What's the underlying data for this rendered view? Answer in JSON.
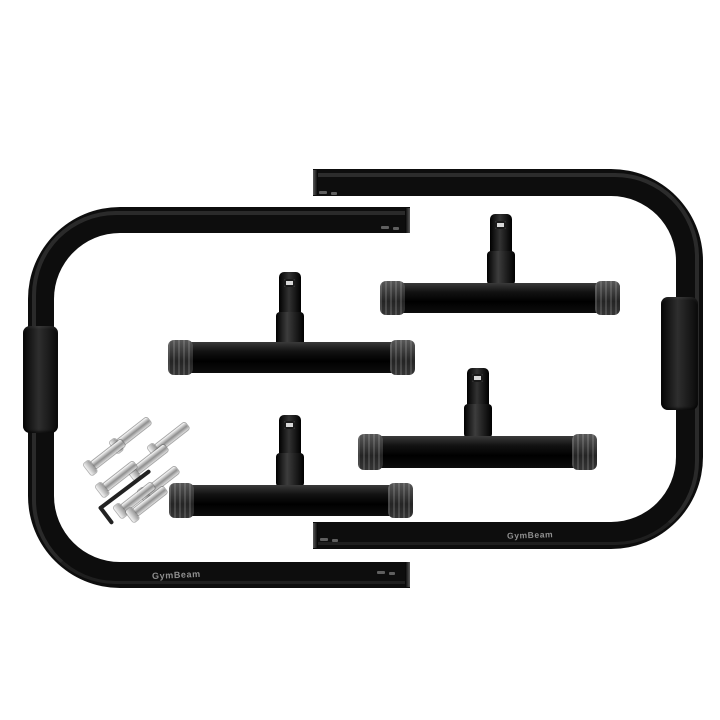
{
  "branding": {
    "left_tube_text": "GymBeam",
    "right_tube_text": "GymBeam"
  },
  "colors": {
    "background": "#ffffff",
    "tube_black": "#0d0d0d",
    "grip_black": "#1c1c1c",
    "end_cap_gray": "#3a3a3a",
    "screw_silver": "#cccccc",
    "brand_text_gray": "#8f8f8f"
  }
}
